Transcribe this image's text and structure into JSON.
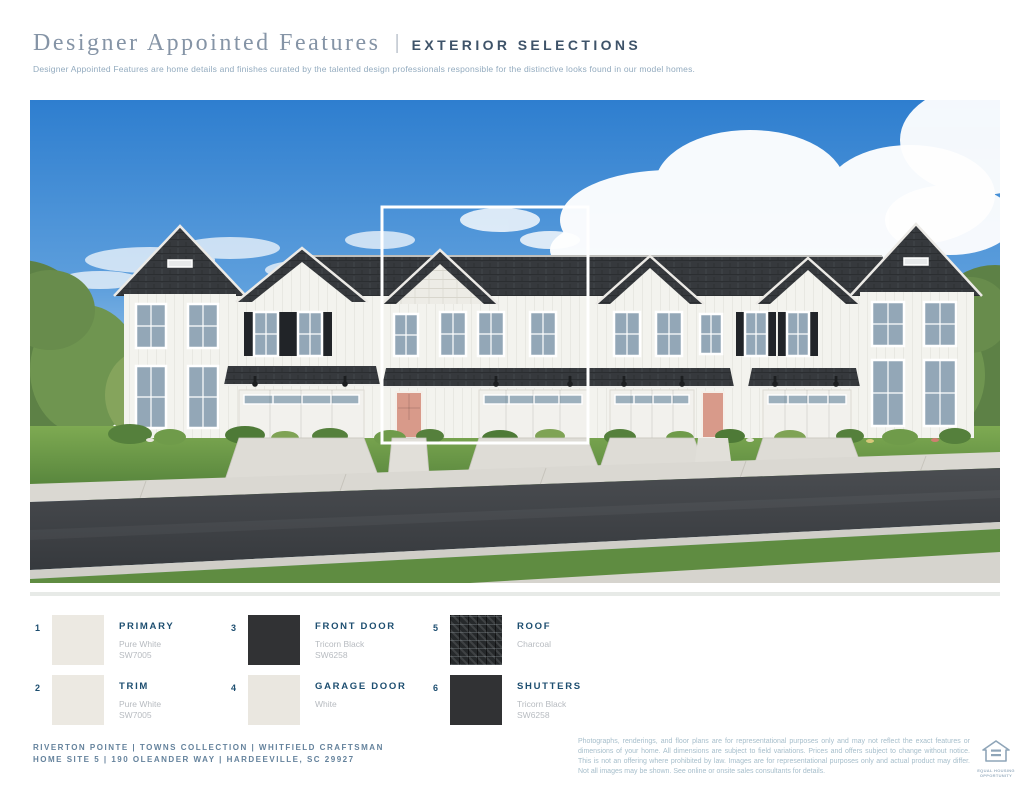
{
  "header": {
    "title_serif": "Designer Appointed Features",
    "divider": "|",
    "title_caps": "EXTERIOR SELECTIONS",
    "subtitle": "Designer Appointed Features are home details and finishes curated by the talented design professionals responsible for the distinctive looks found in our model homes."
  },
  "selections": [
    {
      "num": "1",
      "name": "PRIMARY",
      "line1": "Pure White",
      "line2": "SW7005",
      "swatch_hex": "#ece9e2"
    },
    {
      "num": "2",
      "name": "TRIM",
      "line1": "Pure White",
      "line2": "SW7005",
      "swatch_hex": "#ece9e2"
    },
    {
      "num": "3",
      "name": "FRONT DOOR",
      "line1": "Tricorn Black",
      "line2": "SW6258",
      "swatch_hex": "#313234"
    },
    {
      "num": "4",
      "name": "GARAGE DOOR",
      "line1": "White",
      "line2": "",
      "swatch_hex": "#eae7e0"
    },
    {
      "num": "5",
      "name": "ROOF",
      "line1": "Charcoal",
      "line2": "",
      "swatch_hex": "#26292b",
      "texture": "shingle"
    },
    {
      "num": "6",
      "name": "SHUTTERS",
      "line1": "Tricorn Black",
      "line2": "SW6258",
      "swatch_hex": "#313234"
    }
  ],
  "rendering": {
    "description": "Street rendering of white board-and-batten craftsman townhomes with charcoal roofs, black shutters, salmon front doors; center unit outlined in white",
    "highlight_color": "#ffffff"
  },
  "footer": {
    "line1": "RIVERTON POINTE  |  TOWNS COLLECTION  |  WHITFIELD CRAFTSMAN",
    "line2": "HOME SITE 5 | 190 OLEANDER WAY | HARDEEVILLE, SC 29927",
    "disclaimer": "Photographs, renderings, and floor plans are for representational purposes only and may not reflect the exact features or dimensions of your home. All dimensions are subject to field variations. Prices and offers subject to change without notice. This is not an offering where prohibited by law. Images are for representational purposes only and actual product may differ. Not all images may be shown. See online or onsite sales consultants for details.",
    "equal_housing_line1": "EQUAL HOUSING",
    "equal_housing_line2": "OPPORTUNITY"
  },
  "colors": {
    "accent_navy": "#1d4e70",
    "title_slate": "#8594a6",
    "caps_navy": "#3e5369",
    "muted_blue": "#93abbf",
    "footer_slate": "#64829c",
    "disclaimer_blue": "#a6becb",
    "sky_blue": "#2e7ecf",
    "roof_charcoal": "#36393d",
    "door_salmon": "#d89a8a"
  }
}
